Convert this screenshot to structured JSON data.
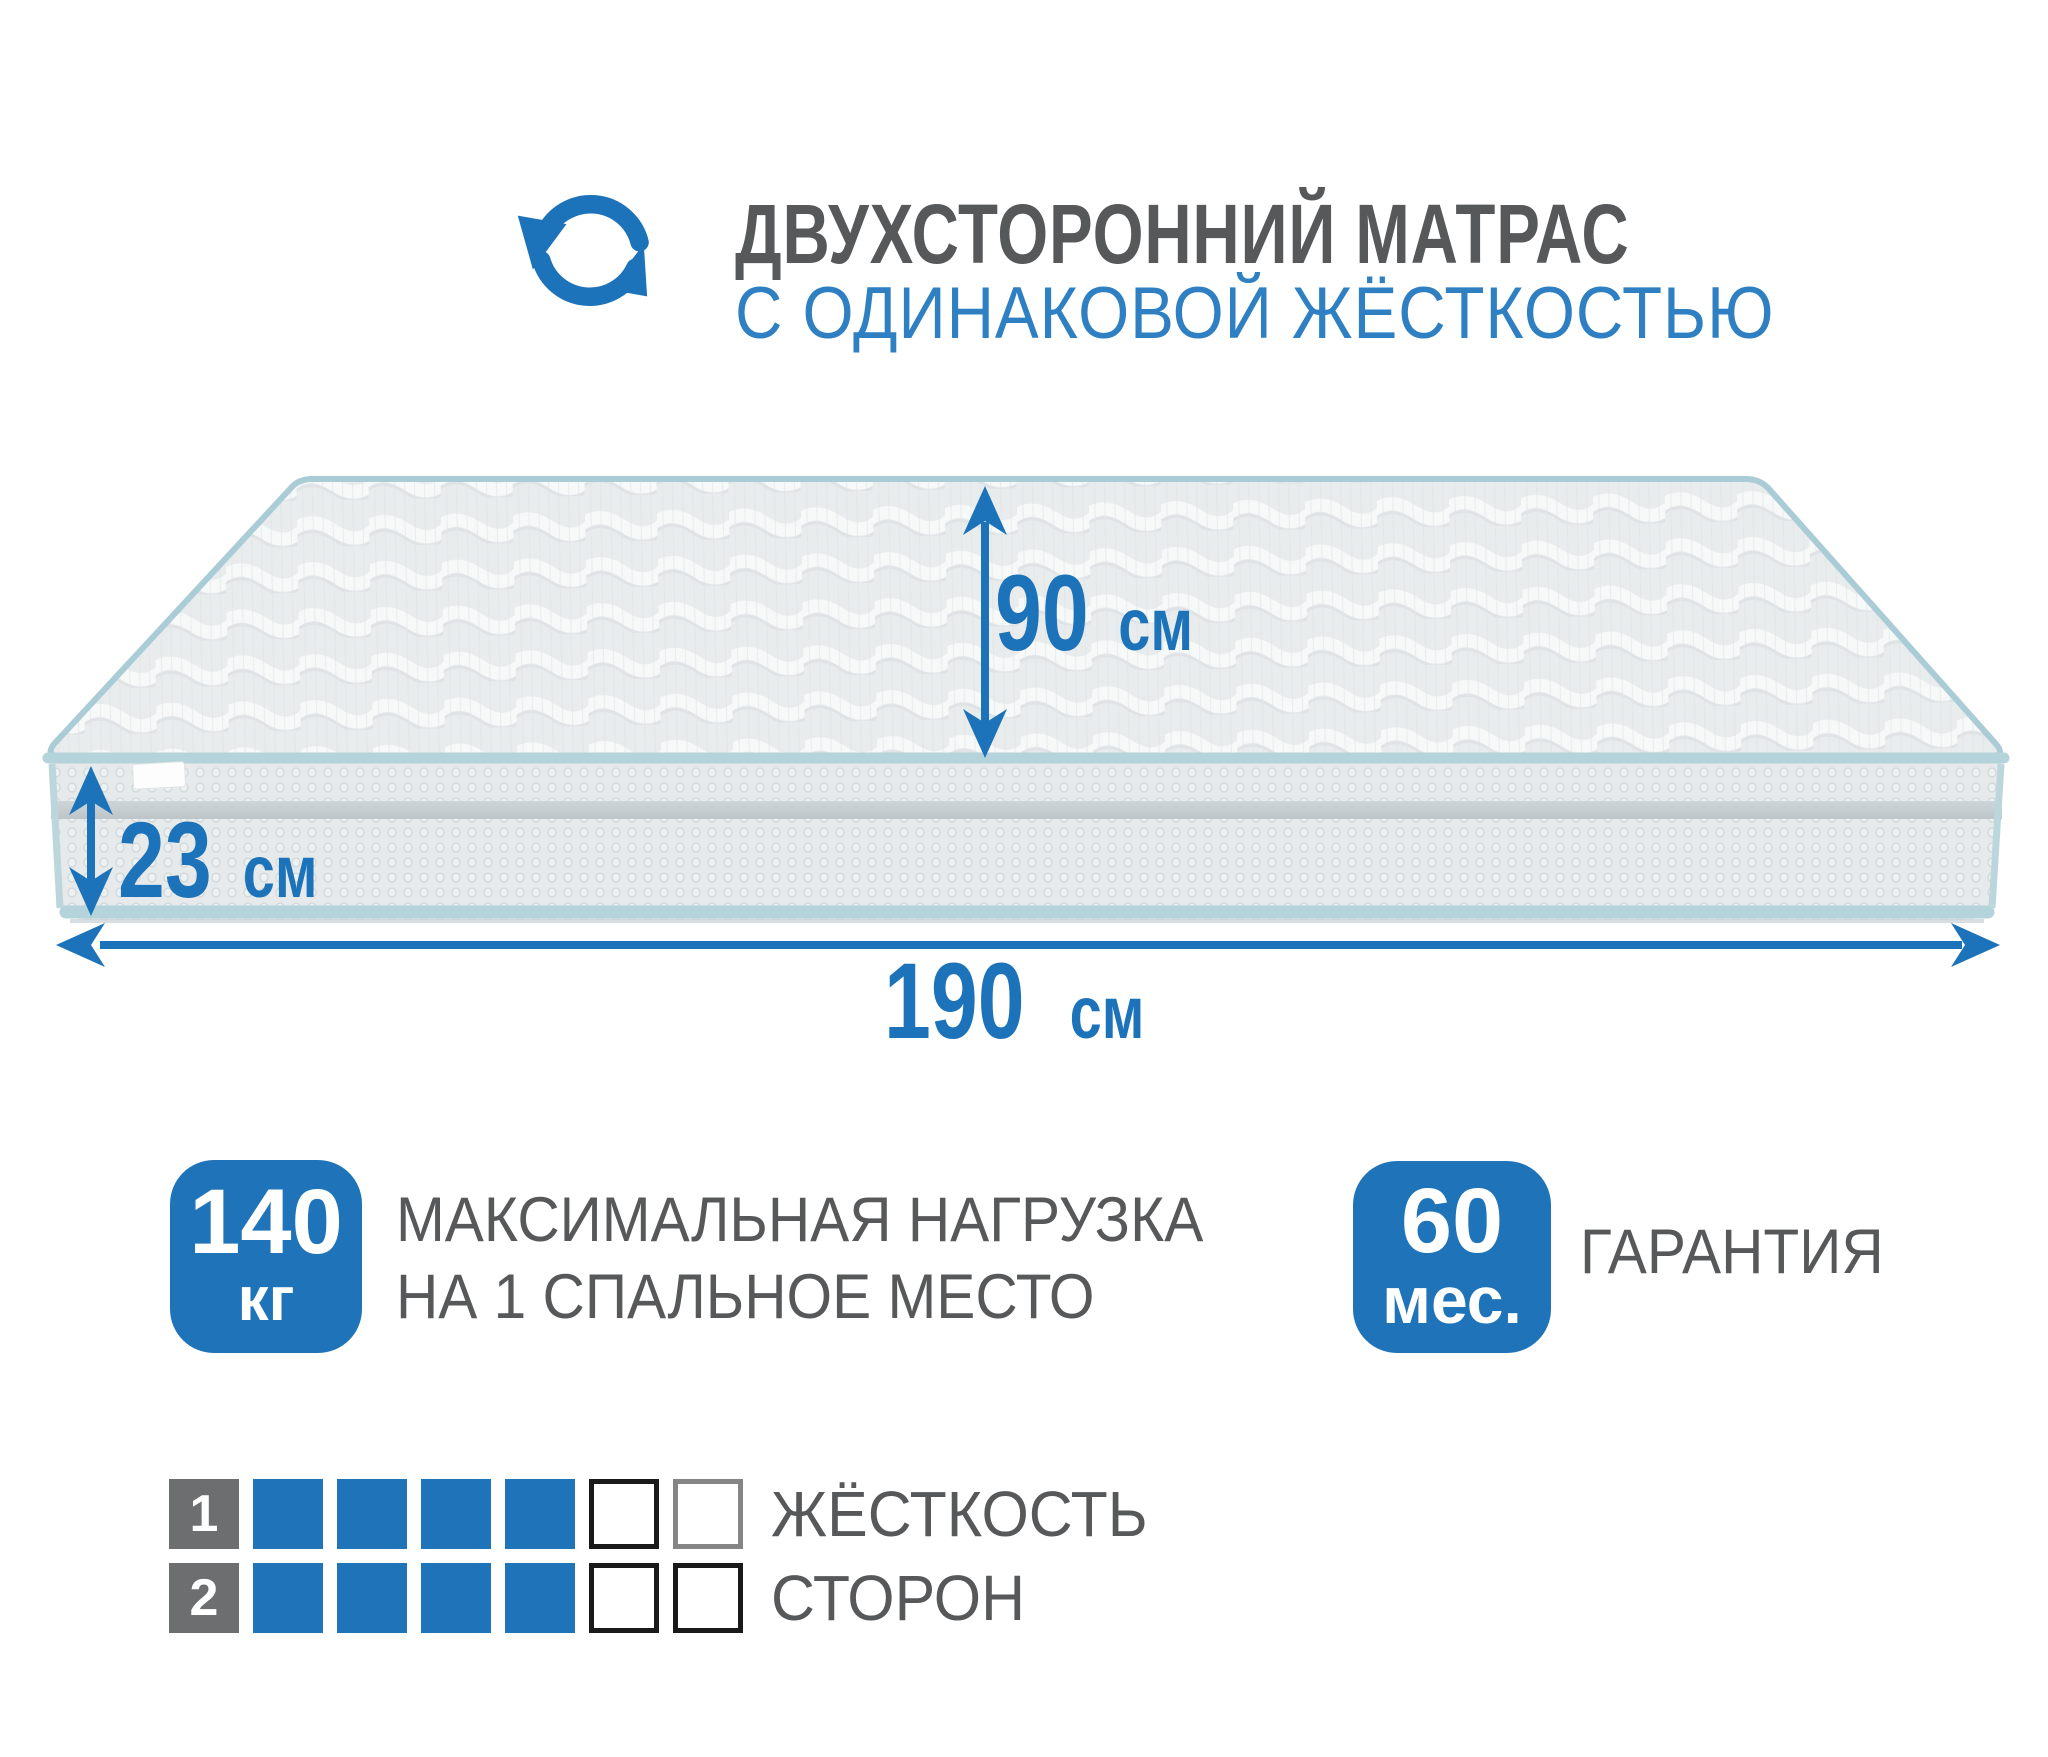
{
  "colors": {
    "accent": "#1d73b9",
    "badge_blue": "#1f74b9",
    "text_gray": "#57585a",
    "subtitle_blue": "#2e80c3",
    "piping": "#aacdd6",
    "scale_number_gray": "#6d6e70"
  },
  "header": {
    "icon": "rotate-arrows-icon",
    "title": "ДВУХСТОРОННИЙ МАТРАС",
    "subtitle": "С ОДИНАКОВОЙ ЖЁСТКОСТЬЮ"
  },
  "dimensions": {
    "width": {
      "value": "90",
      "unit": "см"
    },
    "height": {
      "value": "23",
      "unit": "см"
    },
    "length": {
      "value": "190",
      "unit": "см"
    }
  },
  "features": [
    {
      "value": "140",
      "unit": "кг",
      "lines": [
        "МАКСИМАЛЬНАЯ НАГРУЗКА",
        "НА 1 СПАЛЬНОЕ МЕСТО"
      ]
    },
    {
      "value": "60",
      "unit": "мес.",
      "lines": [
        "ГАРАНТИЯ"
      ]
    }
  ],
  "firmness": {
    "scale_total": 6,
    "rows": [
      {
        "number": "1",
        "filled": 4,
        "empty": 2
      },
      {
        "number": "2",
        "filled": 4,
        "empty": 2
      }
    ],
    "label_lines": [
      "ЖЁСТКОСТЬ",
      "СТОРОН"
    ]
  }
}
